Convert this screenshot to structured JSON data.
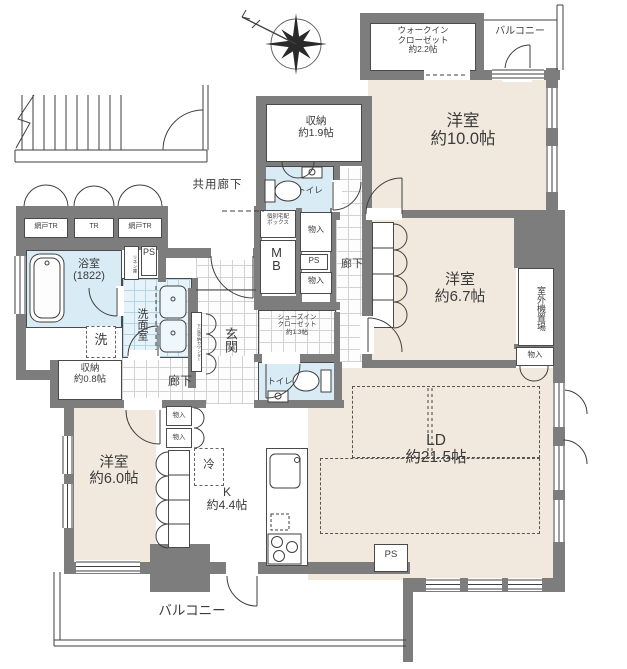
{
  "plan": {
    "exterior": {
      "common_corridor": "共用廊下",
      "balcony": "バルコニー",
      "trunk_mesh": "網戸TR",
      "trunk": "TR",
      "outdoor_unit": "室外機置場"
    },
    "rooms": {
      "wic": {
        "l1": "ウォークイン",
        "l2": "クローゼット",
        "l3": "約2.2帖"
      },
      "bedroom10": {
        "l1": "洋室",
        "l2": "約10.0帖"
      },
      "bedroom67": {
        "l1": "洋室",
        "l2": "約6.7帖"
      },
      "bedroom60": {
        "l1": "洋室",
        "l2": "約6.0帖"
      },
      "ld": {
        "l1": "LD",
        "l2": "約21.5帖"
      },
      "kitchen": {
        "l1": "K",
        "l2": "約4.4帖"
      },
      "storage19": {
        "l1": "収納",
        "l2": "約1.9帖"
      },
      "storage08": {
        "l1": "収納",
        "l2": "約0.8帖"
      },
      "sic": {
        "l1": "シューズイン",
        "l2": "クローゼット",
        "l3": "約1.3帖"
      },
      "bath": {
        "l1": "浴室",
        "l2": "(1822)"
      },
      "washroom": "洗面室",
      "entrance": "玄関",
      "corridor": "廊下",
      "toilet": "トイレ"
    },
    "fixtures": {
      "laundry": "洗",
      "fridge": "冷",
      "linen": "リネン庫",
      "shoe_counter": "下足収納カウンター",
      "delivery": {
        "l1": "個別宅配",
        "l2": "ボックス"
      },
      "mb": "MB",
      "ps": "PS",
      "monoire": "物入"
    },
    "colors": {
      "wall": "#7d7d7d",
      "room_floor": "#f1e9de",
      "wet_area": "#d9ecf6"
    }
  }
}
